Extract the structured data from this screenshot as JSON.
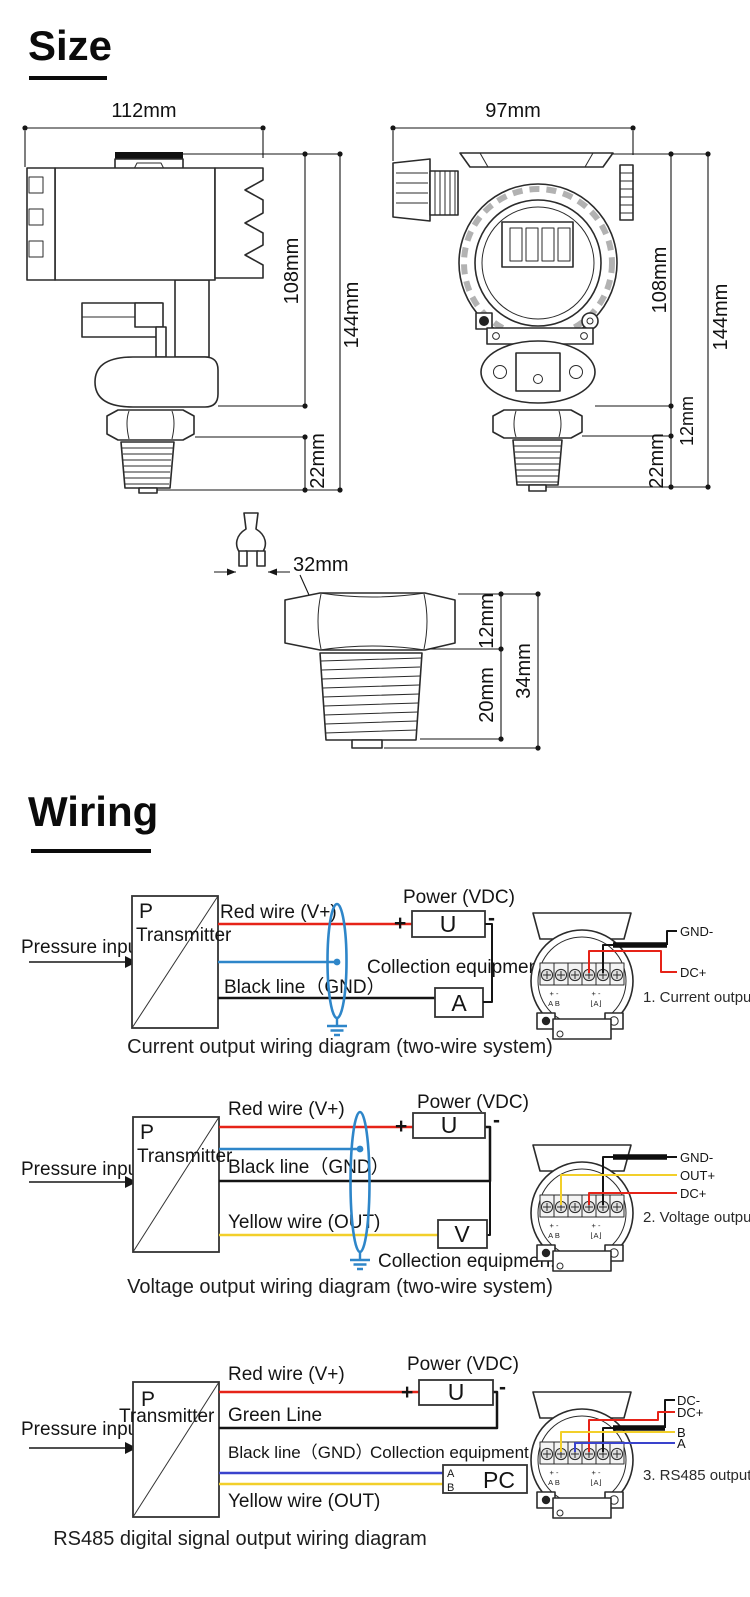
{
  "page": {
    "background": "#ffffff"
  },
  "size": {
    "title": "Size",
    "side_view": {
      "width": "112mm",
      "body_height": "108mm",
      "total_height": "144mm",
      "thread_len": "22mm"
    },
    "front_view": {
      "width": "97mm",
      "body_height": "108mm",
      "total_height": "144mm",
      "bracket": "12mm",
      "thread_len": "22mm"
    },
    "fitting": {
      "wrench_flat": "32mm",
      "hex_height": "12mm",
      "thread_len": "20mm",
      "total_len": "34mm"
    }
  },
  "wiring": {
    "title": "Wiring",
    "terminal": {
      "pm": "+ -",
      "ab": "A B",
      "meter": "⌊A⌋"
    },
    "colors": {
      "red": "#e62318",
      "black": "#141414",
      "shield_blue": "#2e86c9",
      "rs485_blue": "#3a43cc",
      "yellow": "#f2cf2a"
    },
    "d1": {
      "input": "Pressure input",
      "p": "P",
      "transmitter": "Transmitter",
      "red": "Red wire (V+)",
      "black": "Black line（GND）",
      "power": "Power (VDC)",
      "plus": "+",
      "minus": "-",
      "u": "U",
      "a": "A",
      "collection": "Collection equipment",
      "out1": "GND-",
      "out2": "DC+",
      "type": "1. Current output",
      "caption": "Current output wiring diagram (two-wire system)"
    },
    "d2": {
      "input": "Pressure input",
      "p": "P",
      "transmitter": "Transmitter",
      "red": "Red wire (V+)",
      "black": "Black line（GND）",
      "yellow": "Yellow wire (OUT)",
      "power": "Power (VDC)",
      "plus": "+",
      "minus": "-",
      "u": "U",
      "v": "V",
      "collection": "Collection equipmen.",
      "out1": "GND-",
      "out2": "OUT+",
      "out3": "DC+",
      "type": "2. Voltage output",
      "caption": "Voltage output wiring diagram (two-wire system)"
    },
    "d3": {
      "input": "Pressure input",
      "p": "P",
      "transmitter": "Transmitter",
      "red": "Red wire (V+)",
      "green": "Green Line",
      "black": "Black line（GND）",
      "yellow": "Yellow wire (OUT)",
      "power": "Power (VDC)",
      "plus": "+",
      "minus": "-",
      "u": "U",
      "collection": "Collection equipment",
      "pc": "PC",
      "pc_a": "A",
      "pc_b": "B",
      "out1": "DC-",
      "out2": "DC+",
      "out3": "B",
      "out4": "A",
      "type": "3. RS485 output",
      "caption": "RS485 digital signal output wiring diagram"
    }
  }
}
